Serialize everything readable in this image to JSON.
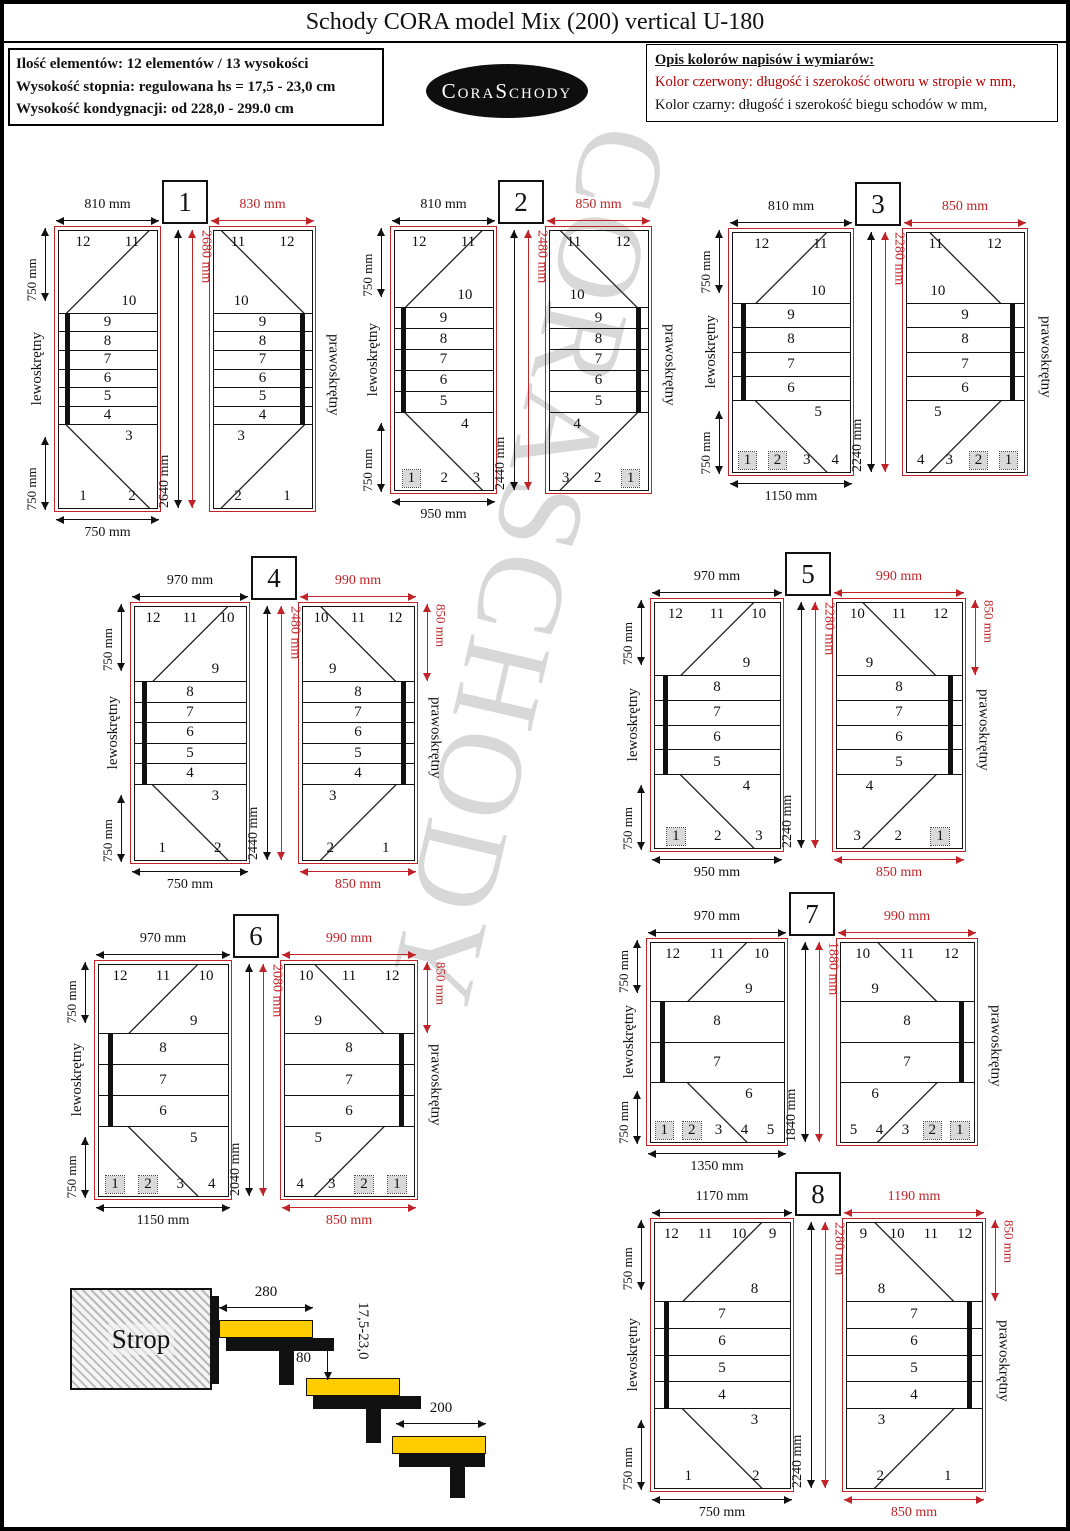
{
  "header": {
    "title": "Schody CORA model Mix (200) vertical U-180",
    "info_lines": [
      "Ilość elementów: 12 elementów / 13 wysokości",
      "Wysokość stopnia: regulowana  hs = 17,5 - 23,0 cm",
      "Wysokość kondygnacji: od 228,0 - 299.0 cm"
    ],
    "logo_text": "CoraSchody",
    "legend": {
      "heading": "Opis kolorów napisów i wymiarów:",
      "red_line": "Kolor czerwony:  długość i szerokość otworu w stropie w mm,",
      "black_line": "Kolor czarny:  długość i szerokość biegu schodów w mm,"
    }
  },
  "labels": {
    "left_plan": "lewoskrętny",
    "right_plan": "prawoskrętny"
  },
  "colors": {
    "dimension_red": "#c02428",
    "dimension_black": "#111111",
    "outside_step_gray": "#d9d9d9",
    "tread_yellow": "#ffcc00"
  },
  "watermark": "CORASCHODY",
  "diagrams": [
    {
      "num": "1",
      "black_top": "810 mm",
      "red_top": "830 mm",
      "black_height": "2640 mm",
      "red_height": "2680 mm",
      "side_top": "750 mm",
      "side_bottom": "750 mm",
      "black_bottom": "750 mm",
      "red_bottom": "",
      "red_side": "",
      "top_row": [
        "12",
        "11"
      ],
      "top_sub": "10",
      "middle": [
        "9",
        "8",
        "7",
        "6",
        "5",
        "4"
      ],
      "bottom_sub": "3",
      "bottom_row": [
        "1",
        "2"
      ],
      "gray": []
    },
    {
      "num": "2",
      "black_top": "810 mm",
      "red_top": "850 mm",
      "black_height": "2440 mm",
      "red_height": "2480 mm",
      "side_top": "750 mm",
      "side_bottom": "750 mm",
      "black_bottom": "950 mm",
      "red_bottom": "",
      "red_side": "",
      "top_row": [
        "12",
        "11"
      ],
      "top_sub": "10",
      "middle": [
        "9",
        "8",
        "7",
        "6",
        "5"
      ],
      "bottom_sub": "4",
      "bottom_row": [
        "1",
        "2",
        "3"
      ],
      "gray": [
        "1"
      ]
    },
    {
      "num": "3",
      "black_top": "810 mm",
      "red_top": "850 mm",
      "black_height": "2240 mm",
      "red_height": "2280 mm",
      "side_top": "750 mm",
      "side_bottom": "750 mm",
      "black_bottom": "1150 mm",
      "red_bottom": "",
      "red_side": "",
      "top_row": [
        "12",
        "11"
      ],
      "top_sub": "10",
      "middle": [
        "9",
        "8",
        "7",
        "6"
      ],
      "bottom_sub": "5",
      "bottom_row": [
        "1",
        "2",
        "3",
        "4"
      ],
      "gray": [
        "1",
        "2"
      ]
    },
    {
      "num": "4",
      "black_top": "970 mm",
      "red_top": "990 mm",
      "black_height": "2440 mm",
      "red_height": "2480 mm",
      "side_top": "750 mm",
      "side_bottom": "750 mm",
      "black_bottom": "750 mm",
      "red_bottom": "850 mm",
      "red_side": "850 mm",
      "top_row": [
        "12",
        "11",
        "10"
      ],
      "top_sub": "9",
      "middle": [
        "8",
        "7",
        "6",
        "5",
        "4"
      ],
      "bottom_sub": "3",
      "bottom_row": [
        "1",
        "2"
      ],
      "gray": []
    },
    {
      "num": "5",
      "black_top": "970 mm",
      "red_top": "990 mm",
      "black_height": "2240 mm",
      "red_height": "2280 mm",
      "side_top": "750 mm",
      "side_bottom": "750 mm",
      "black_bottom": "950 mm",
      "red_bottom": "850 mm",
      "red_side": "850 mm",
      "top_row": [
        "12",
        "11",
        "10"
      ],
      "top_sub": "9",
      "middle": [
        "8",
        "7",
        "6",
        "5"
      ],
      "bottom_sub": "4",
      "bottom_row": [
        "1",
        "2",
        "3"
      ],
      "gray": [
        "1"
      ]
    },
    {
      "num": "6",
      "black_top": "970 mm",
      "red_top": "990 mm",
      "black_height": "2040 mm",
      "red_height": "2080 mm",
      "side_top": "750 mm",
      "side_bottom": "750 mm",
      "black_bottom": "1150 mm",
      "red_bottom": "850 mm",
      "red_side": "850 mm",
      "top_row": [
        "12",
        "11",
        "10"
      ],
      "top_sub": "9",
      "middle": [
        "8",
        "7",
        "6"
      ],
      "bottom_sub": "5",
      "bottom_row": [
        "1",
        "2",
        "3",
        "4"
      ],
      "gray": [
        "1",
        "2"
      ]
    },
    {
      "num": "7",
      "black_top": "970 mm",
      "red_top": "990 mm",
      "black_height": "1840 mm",
      "red_height": "1880 mm",
      "side_top": "750 mm",
      "side_bottom": "750 mm",
      "black_bottom": "1350 mm",
      "red_bottom": "",
      "red_side": "",
      "top_row": [
        "12",
        "11",
        "10"
      ],
      "top_sub": "9",
      "middle": [
        "8",
        "7"
      ],
      "bottom_sub": "6",
      "bottom_row": [
        "1",
        "2",
        "3",
        "4",
        "5"
      ],
      "gray": [
        "1",
        "2"
      ]
    },
    {
      "num": "8",
      "black_top": "1170 mm",
      "red_top": "1190 mm",
      "black_height": "2240 mm",
      "red_height": "2280 mm",
      "side_top": "750 mm",
      "side_bottom": "750 mm",
      "black_bottom": "750 mm",
      "red_bottom": "850 mm",
      "red_side": "850 mm",
      "top_row": [
        "12",
        "11",
        "10",
        "9"
      ],
      "top_sub": "8",
      "middle": [
        "7",
        "6",
        "5",
        "4"
      ],
      "bottom_sub": "3",
      "bottom_row": [
        "1",
        "2"
      ],
      "gray": []
    }
  ],
  "section": {
    "strop_label": "Strop",
    "tread_depth_top": "280",
    "nose_overlap": "80",
    "riser_range": "17,5-23,0",
    "tread_depth_bottom": "200"
  }
}
